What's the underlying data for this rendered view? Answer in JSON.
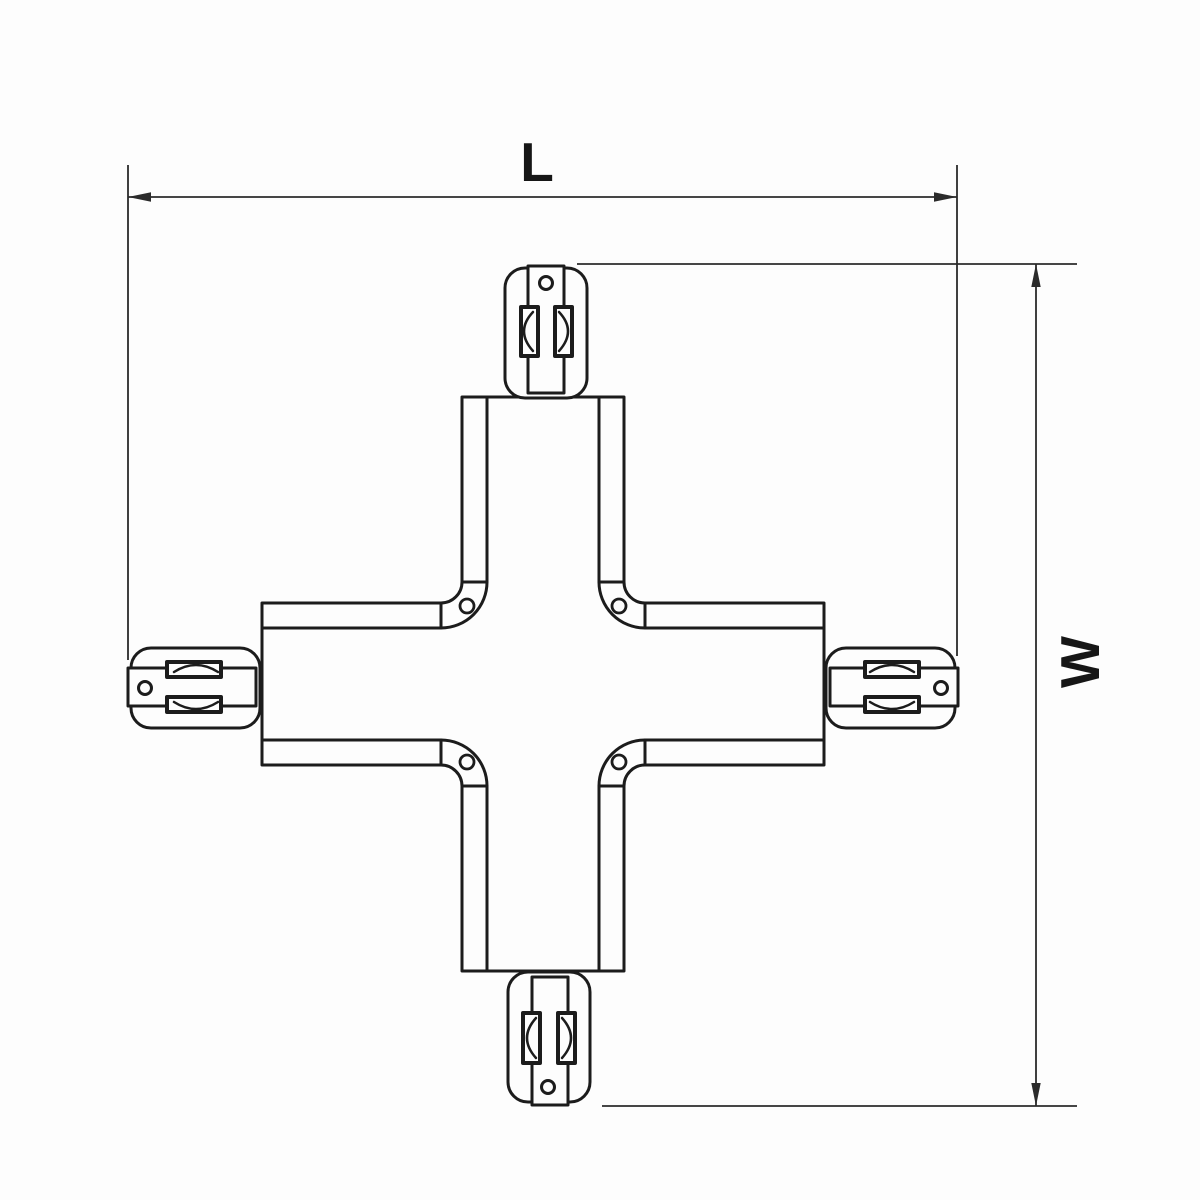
{
  "colors": {
    "line": "#1c1c1c",
    "dimension_line": "#2b2b2b",
    "background": "#fdfdfd"
  },
  "dimensions": {
    "length": {
      "label": "L",
      "orientation": "horizontal"
    },
    "width": {
      "label": "W",
      "orientation": "vertical"
    }
  }
}
